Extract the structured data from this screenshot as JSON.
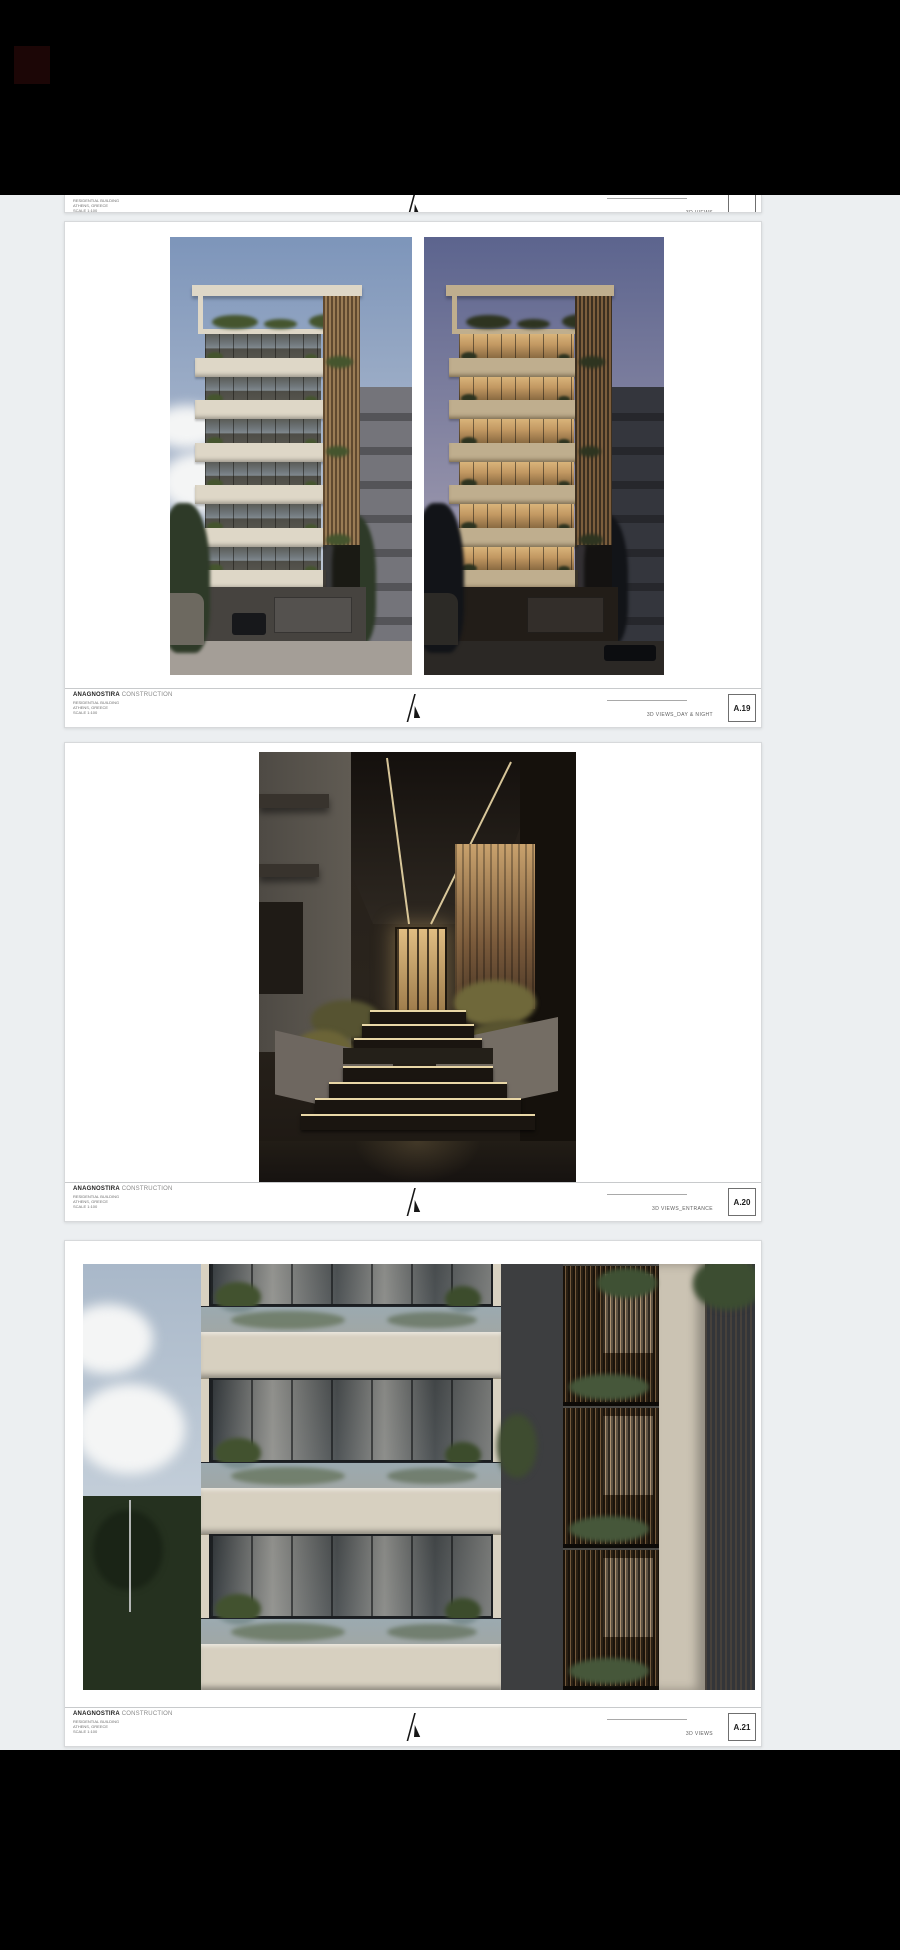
{
  "page": {
    "background": "#000000",
    "viewer_background": "#eceff1",
    "sheet_background": "#ffffff"
  },
  "titleblock": {
    "company_bold": "ANAGNOSTIRA",
    "company_rest": "CONSTRUCTION",
    "details": [
      "RESIDENTIAL BUILDING",
      "ATHENS, GREECE",
      "SCALE 1:100"
    ],
    "logo_icon": "lambda-mark-logo"
  },
  "sheets": [
    {
      "key": "partial-top",
      "label": "3D VIEWS",
      "page_no": ""
    },
    {
      "key": "a19",
      "label": "3D VIEWS_DAY & NIGHT",
      "page_no": "A.19",
      "renders": [
        "building-exterior-day",
        "building-exterior-night"
      ]
    },
    {
      "key": "a20",
      "label": "3D VIEWS_ENTRANCE",
      "page_no": "A.20",
      "renders": [
        "building-entrance-dusk"
      ]
    },
    {
      "key": "a21",
      "label": "3D VIEWS",
      "page_no": "A.21",
      "renders": [
        "facade-closeup"
      ]
    }
  ]
}
